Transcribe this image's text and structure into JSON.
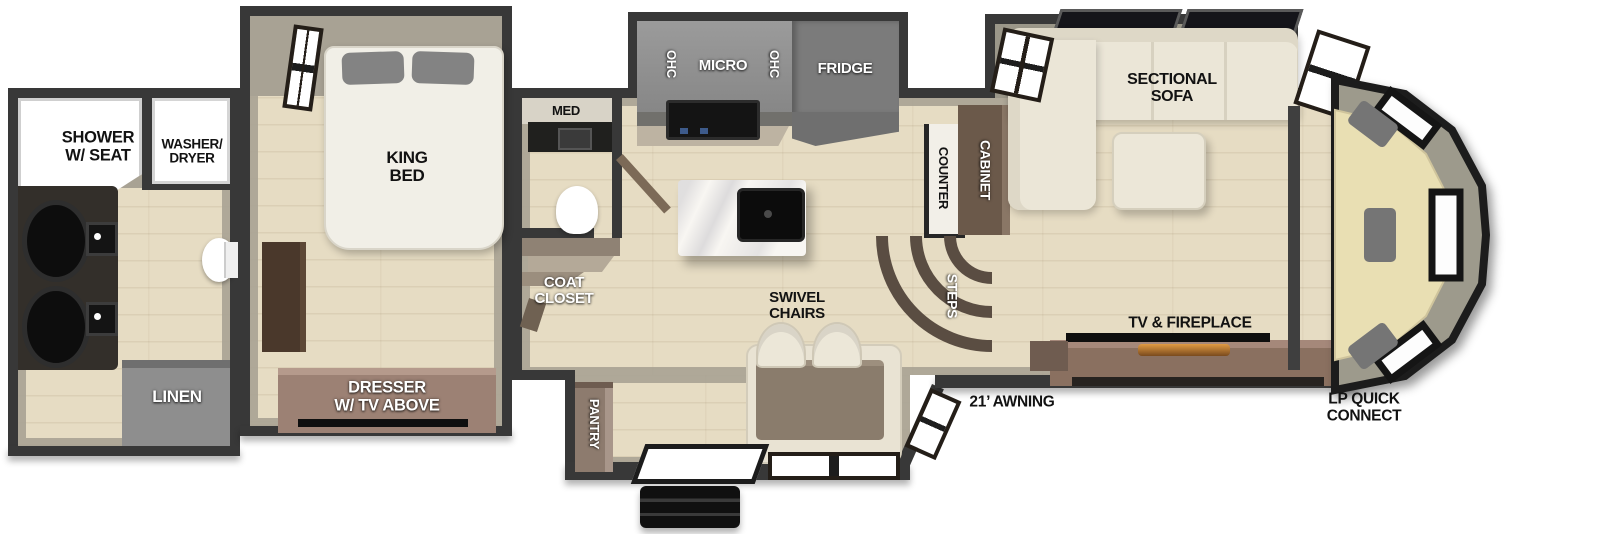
{
  "colors": {
    "wall": "#383838",
    "wall_inner": "#a8a294",
    "floor_wood": "#e6dcc3",
    "cabinet_gray": "#8f8f8f",
    "cabinet_brown": "#6b594a",
    "dresser_brown": "#9c8174",
    "sofa_cream": "#ebe6d7",
    "rear_bench": "#e9dfb3",
    "pillow_gray": "#7a7a7a",
    "appliance_black": "#141414",
    "island_white": "#f8f6f2",
    "steps_brown": "#5a4d42",
    "fireplace_glow": "#d9923f"
  },
  "labels": {
    "shower": "SHOWER\nW/ SEAT",
    "washer_dryer": "WASHER/\nDRYER",
    "linen": "LINEN",
    "king_bed": "KING\nBED",
    "dresser": "DRESSER\nW/ TV ABOVE",
    "med": "MED",
    "coat_closet": "COAT\nCLOSET",
    "ohc_left": "OHC",
    "micro": "MICRO",
    "ohc_right": "OHC",
    "fridge": "FRIDGE",
    "counter": "COUNTER",
    "cabinet": "CABINET",
    "steps": "STEPS",
    "swivel_chairs": "SWIVEL\nCHAIRS",
    "pantry": "PANTRY",
    "sectional_sofa": "SECTIONAL\nSOFA",
    "tv_fireplace": "TV & FIREPLACE",
    "awning": "21’ AWNING",
    "lp_quick_connect": "LP QUICK\nCONNECT"
  }
}
